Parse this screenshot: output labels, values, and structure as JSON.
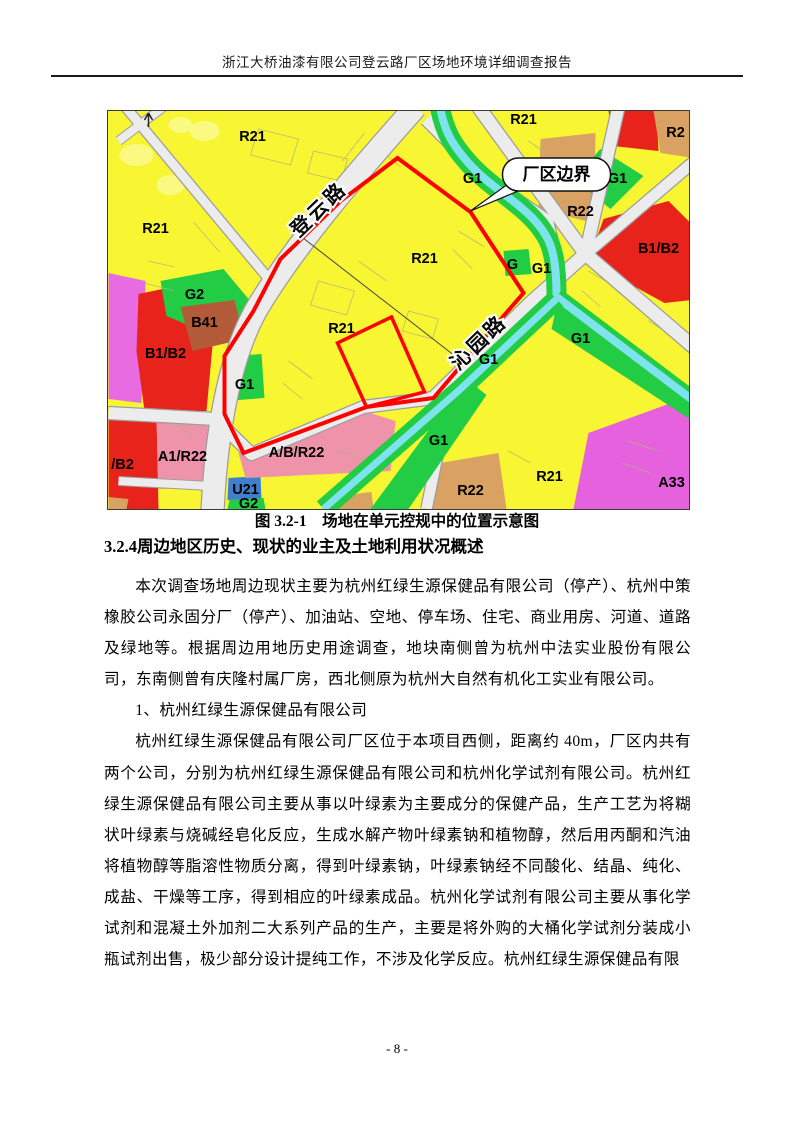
{
  "header": {
    "title": "浙江大桥油漆有限公司登云路厂区场地环境详细调查报告"
  },
  "figure": {
    "caption": "图 3.2-1　场地在单元控规中的位置示意图",
    "callout_label": "厂区边界",
    "colors": {
      "boundary_red": "#fe0000",
      "residential_yellow": "#f8f632",
      "green_space": "#23cc45",
      "water_cyan": "#7fe3ef",
      "commercial_red": "#e8231c",
      "r22_tan": "#d9a263",
      "mixed_pink": "#ef93aa",
      "a33_magenta": "#e561dd",
      "u21_blue": "#3f80cc",
      "b41_brown": "#b35b39",
      "road_gray": "#ececec"
    },
    "road_labels": [
      {
        "text": "登云路",
        "x": 215,
        "y": 103,
        "rotate": -44
      },
      {
        "text": "沁园路",
        "x": 375,
        "y": 236,
        "rotate": -44
      }
    ],
    "zone_labels": [
      {
        "text": "R21",
        "x": 144,
        "y": 30
      },
      {
        "text": "R21",
        "x": 47,
        "y": 122
      },
      {
        "text": "R21",
        "x": 415,
        "y": 13
      },
      {
        "text": "R2",
        "x": 567,
        "y": 26
      },
      {
        "text": "R22",
        "x": 472,
        "y": 105
      },
      {
        "text": "G1",
        "x": 509,
        "y": 72
      },
      {
        "text": "B1/B2",
        "x": 550,
        "y": 142
      },
      {
        "text": "G1",
        "x": 364,
        "y": 72
      },
      {
        "text": "G",
        "x": 404,
        "y": 158
      },
      {
        "text": "G1",
        "x": 433,
        "y": 162
      },
      {
        "text": "G2",
        "x": 86,
        "y": 188
      },
      {
        "text": "B41",
        "x": 96,
        "y": 216
      },
      {
        "text": "B1/B2",
        "x": 57,
        "y": 247
      },
      {
        "text": "R21",
        "x": 316,
        "y": 152
      },
      {
        "text": "R21",
        "x": 233,
        "y": 222
      },
      {
        "text": "G1",
        "x": 136,
        "y": 278
      },
      {
        "text": "G1",
        "x": 380,
        "y": 253
      },
      {
        "text": "G1",
        "x": 472,
        "y": 232
      },
      {
        "text": "A1/R22",
        "x": 74,
        "y": 350
      },
      {
        "text": "/B2",
        "x": 14,
        "y": 358
      },
      {
        "text": "A/B/R22",
        "x": 188,
        "y": 346
      },
      {
        "text": "U21",
        "x": 137,
        "y": 383
      },
      {
        "text": "G2",
        "x": 140,
        "y": 397
      },
      {
        "text": "G1",
        "x": 330,
        "y": 334
      },
      {
        "text": "R22",
        "x": 362,
        "y": 384
      },
      {
        "text": "R21",
        "x": 441,
        "y": 370
      },
      {
        "text": "A33",
        "x": 563,
        "y": 376
      }
    ]
  },
  "section": {
    "heading": "3.2.4周边地区历史、现状的业主及土地利用状况概述",
    "paragraphs": [
      "本次调查场地周边现状主要为杭州红绿生源保健品有限公司（停产）、杭州中策橡胶公司永固分厂（停产）、加油站、空地、停车场、住宅、商业用房、河道、道路及绿地等。根据周边用地历史用途调查，地块南侧曾为杭州中法实业股份有限公司，东南侧曾有庆隆村属厂房，西北侧原为杭州大自然有机化工实业有限公司。",
      "1、杭州红绿生源保健品有限公司",
      "杭州红绿生源保健品有限公司厂区位于本项目西侧，距离约 40m，厂区内共有两个公司，分别为杭州红绿生源保健品有限公司和杭州化学试剂有限公司。杭州红绿生源保健品有限公司主要从事以叶绿素为主要成分的保健产品，生产工艺为将糊状叶绿素与烧碱经皂化反应，生成水解产物叶绿素钠和植物醇，然后用丙酮和汽油将植物醇等脂溶性物质分离，得到叶绿素钠，叶绿素钠经不同酸化、结晶、纯化、成盐、干燥等工序，得到相应的叶绿素成品。杭州化学试剂有限公司主要从事化学试剂和混凝土外加剂二大系列产品的生产，主要是将外购的大桶化学试剂分装成小瓶试剂出售，极少部分设计提纯工作，不涉及化学反应。杭州红绿生源保健品有限"
    ]
  },
  "footer": {
    "page_number": "- 8 -"
  }
}
